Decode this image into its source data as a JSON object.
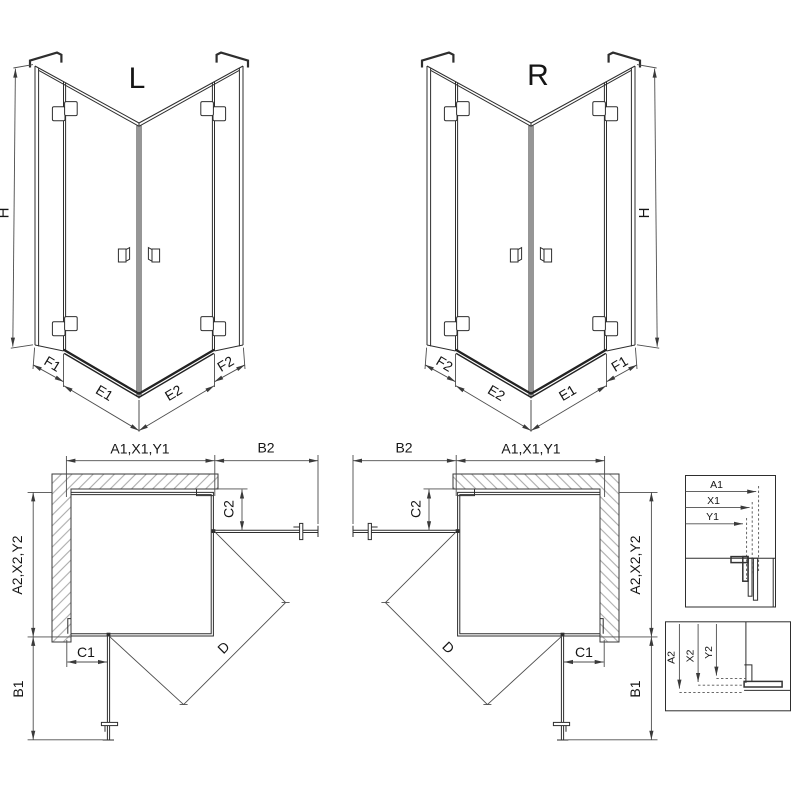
{
  "iso_left": {
    "variant": "L",
    "h": "H",
    "f1": "F1",
    "e1": "E1",
    "e2": "E2",
    "f2": "F2"
  },
  "iso_right": {
    "variant": "R",
    "h": "H",
    "f1": "F1",
    "e1": "E1",
    "e2": "E2",
    "f2": "F2"
  },
  "plan_left": {
    "a1": "A1,X1,Y1",
    "b2": "B2",
    "c2": "C2",
    "a2": "A2,X2,Y2",
    "c1": "C1",
    "b1": "B1",
    "d": "D"
  },
  "plan_right": {
    "a1": "A1,X1,Y1",
    "b2": "B2",
    "c2": "C2",
    "a2": "A2,X2,Y2",
    "c1": "C1",
    "b1": "B1",
    "d": "D"
  },
  "detail_top": {
    "a1": "A1",
    "x1": "X1",
    "y1": "Y1"
  },
  "detail_bottom": {
    "a2": "A2",
    "x2": "X2",
    "y2": "Y2"
  },
  "colors": {
    "line": "#2e2e2e",
    "dim": "#4d4d4d",
    "hatch": "#9a9a9a",
    "text": "#151515",
    "background": "#ffffff"
  }
}
